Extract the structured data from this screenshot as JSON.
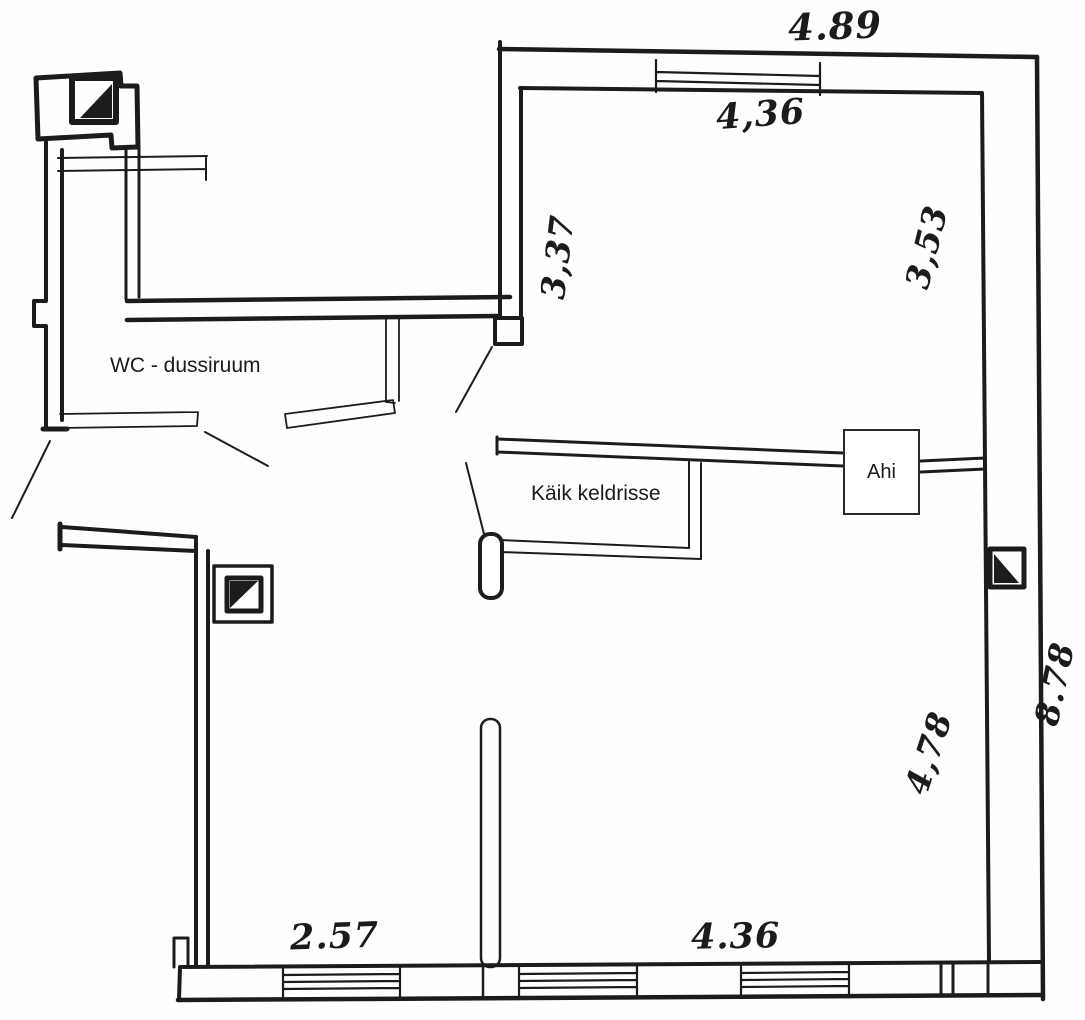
{
  "page": {
    "type": "hand-drawn floor plan",
    "colors": {
      "paper": "#fffefd",
      "ink": "#1c1c1c"
    }
  },
  "labels": {
    "wc_room": "WC - dussiruum",
    "cellar_passage": "Käik keldrisse",
    "stove": "Ahi"
  },
  "dimensions": {
    "top_exterior_width": "4.89",
    "top_room_width": "4,36",
    "hall_left_height": "3,37",
    "top_room_height": "3,53",
    "right_exterior_height": "8.78",
    "bottom_right_room_height": "4,78",
    "bottom_left_room_width": "2.57",
    "bottom_right_room_width": "4.36"
  }
}
